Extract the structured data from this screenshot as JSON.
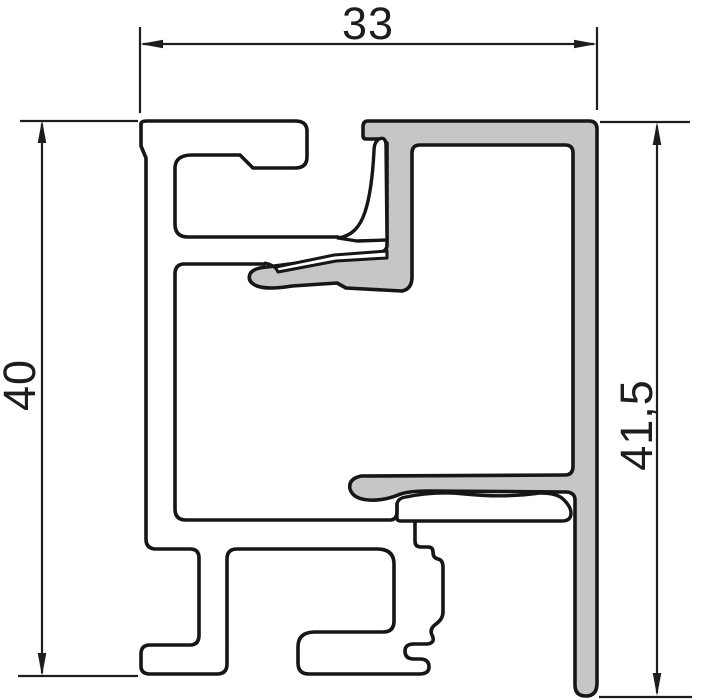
{
  "drawing": {
    "title": "aluminium-profile-cross-section",
    "background_color": "#ffffff",
    "outline_color": "#161616",
    "dimension_line_color": "#1d1d1d",
    "frame_profile_fill": "#ffffff",
    "clip_profile_fill": "#c5c7c5",
    "dimensions": {
      "width_top": {
        "label": "33",
        "orientation": "horizontal"
      },
      "height_left": {
        "label": "40",
        "orientation": "vertical"
      },
      "height_right": {
        "label": "41,5",
        "orientation": "vertical"
      }
    }
  }
}
